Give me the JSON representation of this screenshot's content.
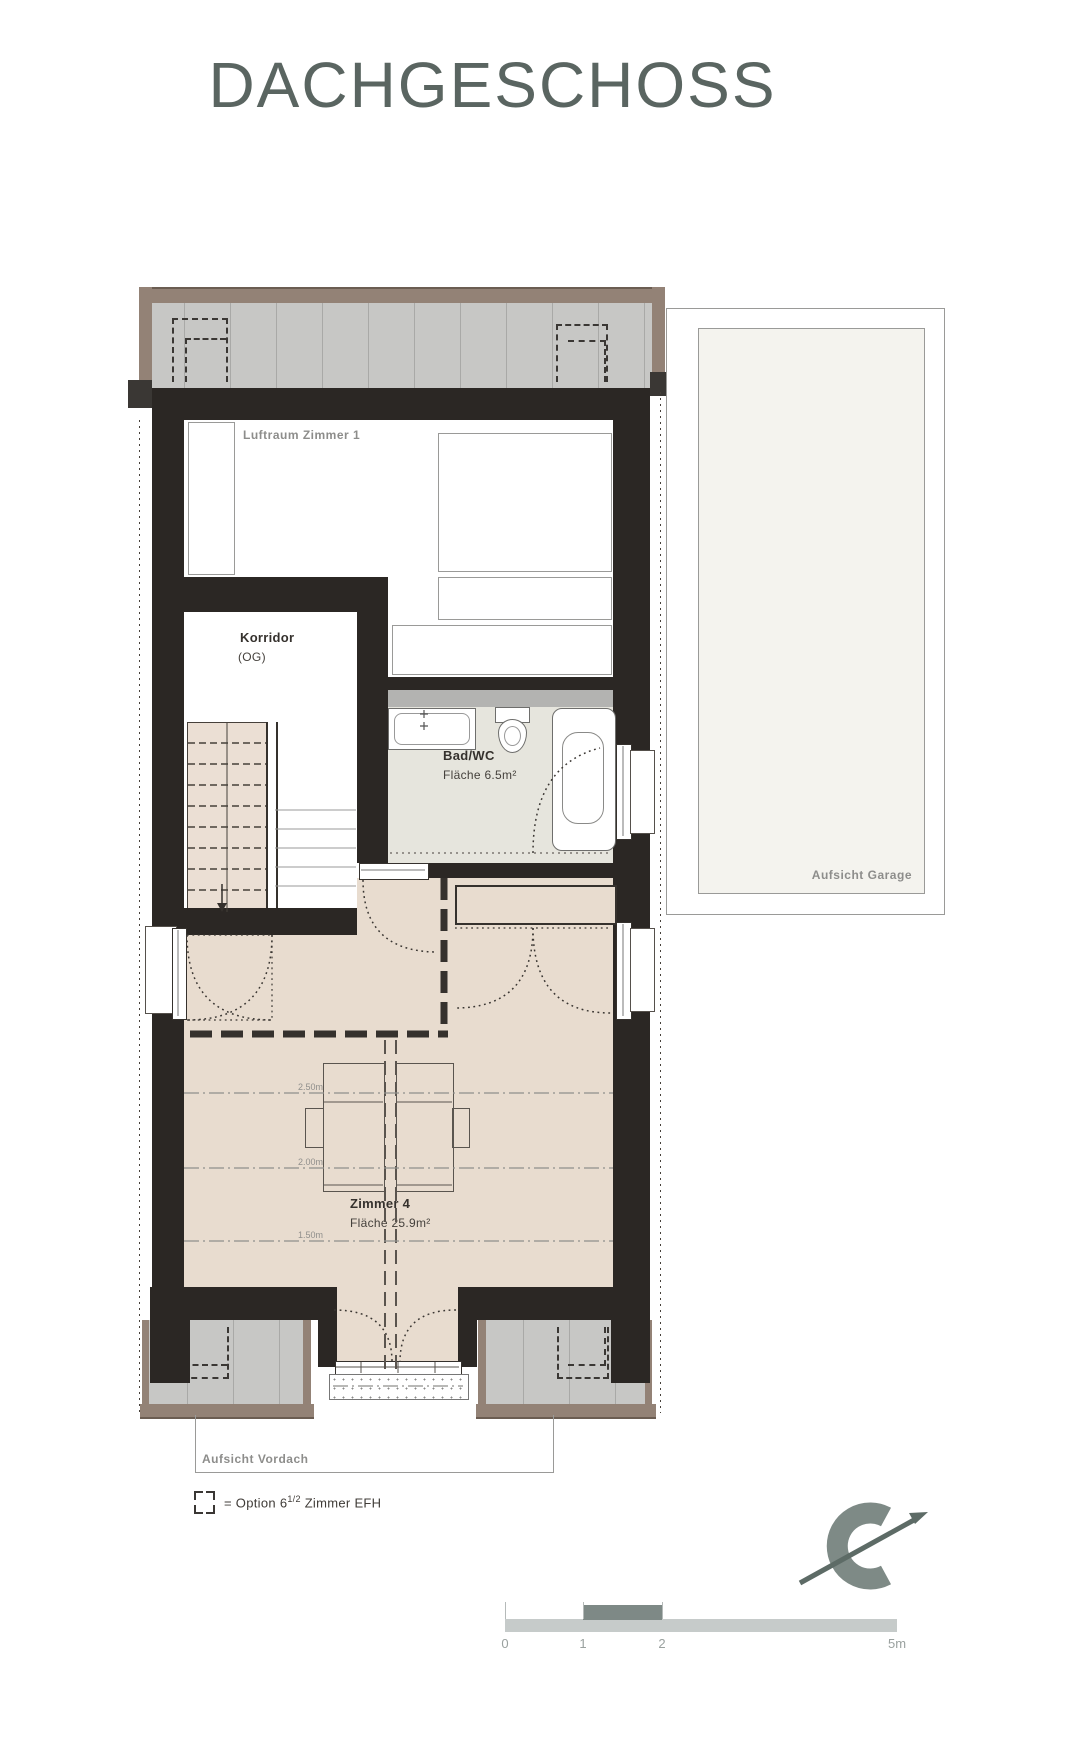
{
  "title": "DACHGESCHOSS",
  "rooms": {
    "luftraum": {
      "name": "Luftraum Zimmer 1"
    },
    "korridor": {
      "name": "Korridor",
      "floor": "(OG)"
    },
    "bad": {
      "name": "Bad/WC",
      "area": "Fläche 6.5m²"
    },
    "zimmer4": {
      "name": "Zimmer 4",
      "area": "Fläche 25.9m²"
    }
  },
  "overlays": {
    "garage": "Aufsicht Garage",
    "vordach": "Aufsicht Vordach"
  },
  "height_lines": [
    "2.50m",
    "2.00m",
    "1.50m"
  ],
  "legend": {
    "equals_prefix": "= Option 6",
    "fraction": "1/2",
    "suffix": " Zimmer EFH"
  },
  "scale_bar": {
    "ticks": [
      "0",
      "1",
      "2",
      "5m"
    ]
  },
  "icons": {
    "compass": "north-arrow-icon"
  },
  "colors": {
    "wall": "#2b2724",
    "roof_gray": "#c7c7c5",
    "roof_brown": "#938276",
    "roof_brown_dark": "#6b5d52",
    "floor_beige": "#e8dccf",
    "floor_bath": "#e6e5dd",
    "counter_gray": "#b3b3b1",
    "stair_beige": "#ebdfd4",
    "garage_fill": "#f4f3ee",
    "title_color": "#5a6561",
    "label_gray": "#8d8d8b",
    "text_dark": "#35312d",
    "scale_light": "#c6cbca",
    "scale_dark": "#7e8986",
    "compass": "#7e8a86"
  }
}
